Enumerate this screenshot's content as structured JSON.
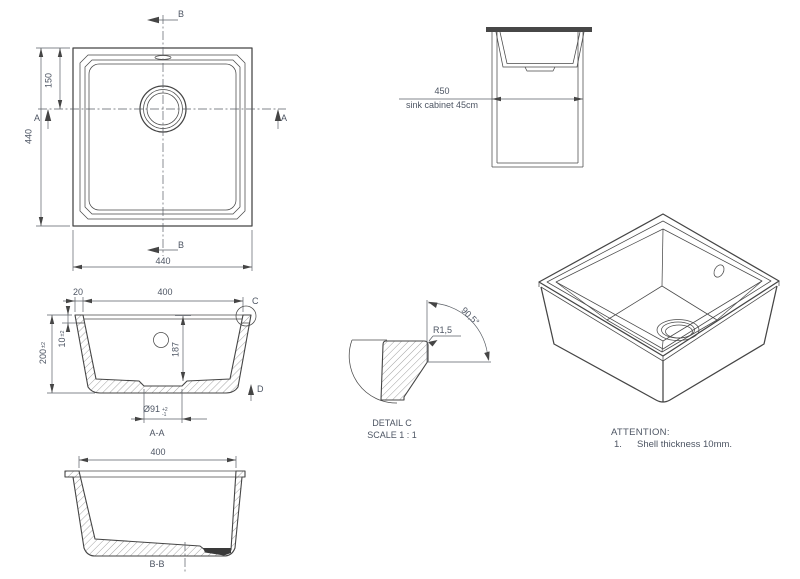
{
  "colors": {
    "background": "#ffffff",
    "line": "#454545",
    "text": "#4d5563",
    "countertop_fill": "#474747",
    "drain_fill": "#3a3a3a"
  },
  "top_view": {
    "section_b_top": "B",
    "section_b_bottom": "B",
    "section_a_left": "A",
    "section_a_right": "A",
    "dim_overall_height": "440",
    "dim_drain_offset": "150",
    "dim_overall_width": "440"
  },
  "cabinet_view": {
    "dim_cabinet_width": "450",
    "caption": "sink cabinet 45cm"
  },
  "section_aa": {
    "dim_rim_width": "20",
    "dim_inner_width": "400",
    "dim_overall_height": "200",
    "dim_overall_height_tol": "±2",
    "dim_rim_height": "10",
    "dim_rim_height_tol": "±2",
    "dim_inner_depth": "187",
    "dim_drain_diameter": "Ø91",
    "dim_drain_tol_upper": "+2",
    "dim_drain_tol_lower": "-1",
    "detail_marker": "C",
    "view_marker": "D",
    "title": "A-A"
  },
  "detail_c": {
    "dim_radius": "R1,5",
    "dim_angle": "90,5°",
    "title": "DETAIL C",
    "scale": "SCALE 1 : 1"
  },
  "section_bb": {
    "dim_inner_width": "400",
    "title": "B-B"
  },
  "notes": {
    "heading": "ATTENTION:",
    "item_number": "1.",
    "item_text": "Shell thickness 10mm."
  }
}
